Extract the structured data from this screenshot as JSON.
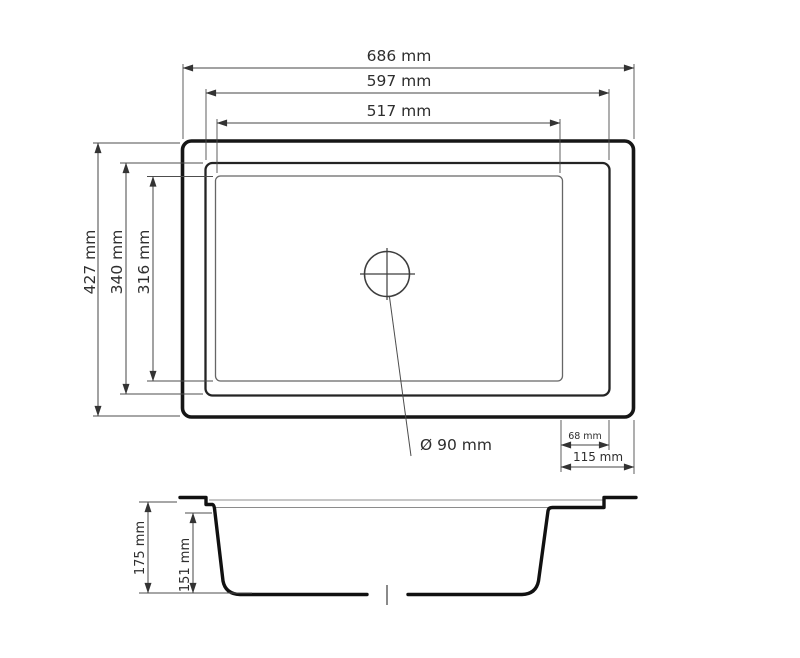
{
  "style": {
    "background_color": "#ffffff",
    "line_color": "#1a1a1a"
  },
  "top_view": {
    "dim_overall_width": "686 mm",
    "dim_rim_width": "597 mm",
    "dim_bowl_width": "517 mm",
    "dim_overall_depth": "427 mm",
    "dim_rim_depth": "340 mm",
    "dim_bowl_depth": "316 mm",
    "dim_drain_diameter": "Ø 90 mm",
    "dim_bowl_to_rim_edge": "68 mm",
    "dim_bowl_to_outer_edge": "115 mm"
  },
  "section_view": {
    "dim_total_height": "175 mm",
    "dim_bowl_height": "151 mm"
  }
}
